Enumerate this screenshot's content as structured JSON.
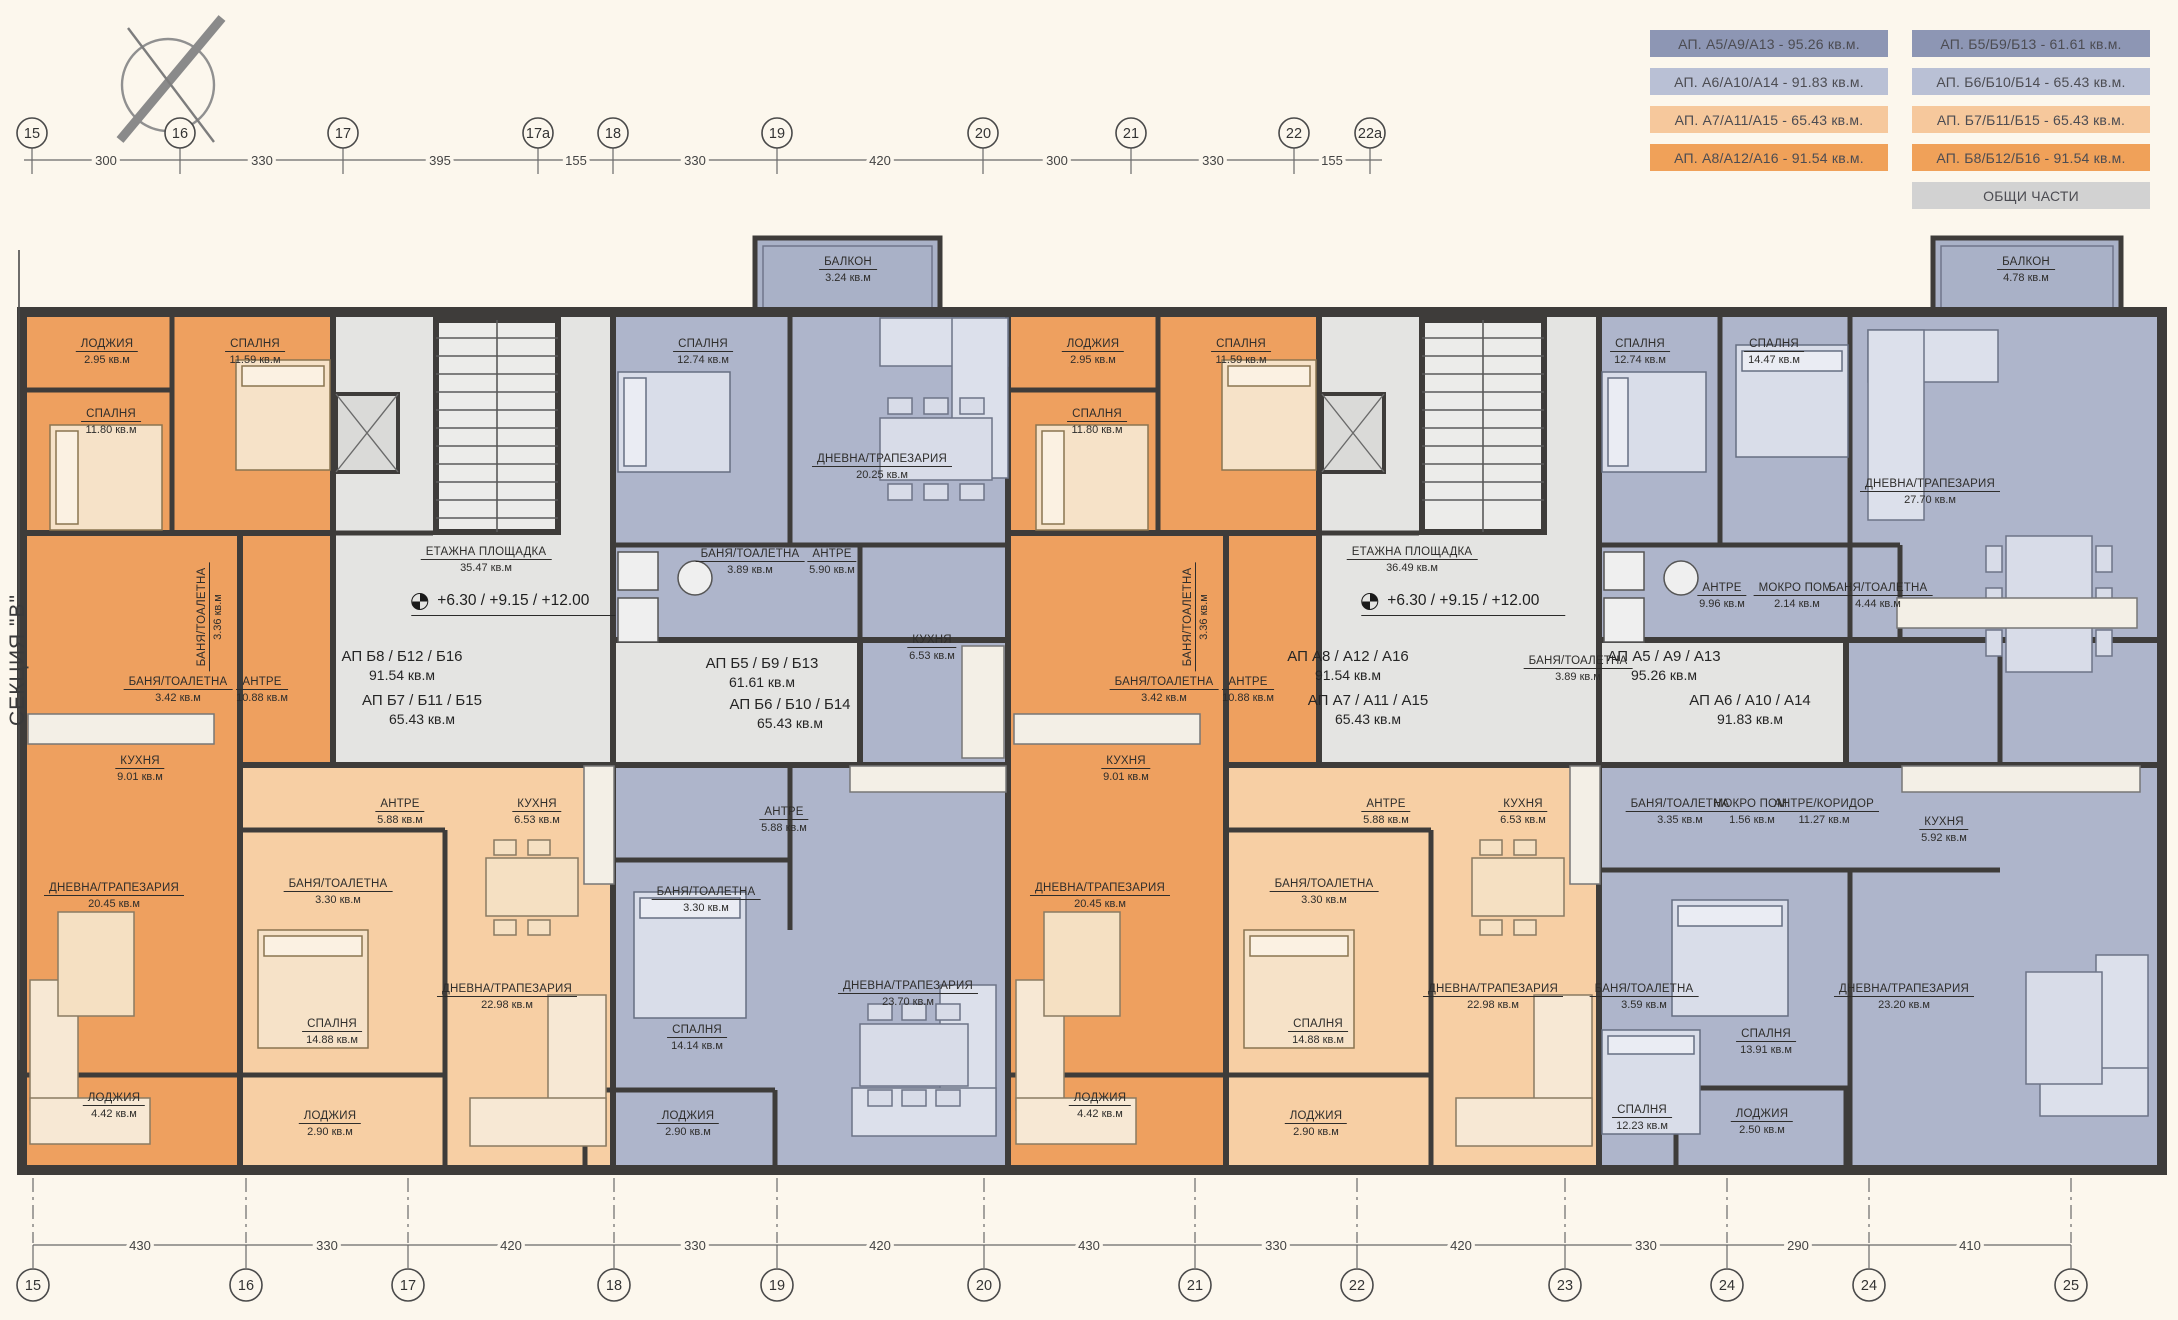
{
  "section_label": "СЕКЦИЯ \"В\"",
  "colors": {
    "dark_orange": "#EEA05F",
    "light_orange": "#F7CFA4",
    "blue": "#AEB5CB",
    "common_gray": "#E4E4E2",
    "wall": "#3E3C3A",
    "background": "#FCF7ED",
    "legend_dark_blue": "#8D96B4",
    "legend_light_blue": "#B9C0D5",
    "legend_light_orange": "#F6C89C",
    "legend_dark_orange": "#F0A159",
    "legend_gray": "#D2D2D2"
  },
  "legend": {
    "common": "ОБЩИ ЧАСТИ",
    "col_a": [
      {
        "label": "АП. А5/А9/А13 - 95.26 кв.м.",
        "color": "#8D96B4"
      },
      {
        "label": "АП. А6/А10/А14 - 91.83 кв.м.",
        "color": "#B9C0D5"
      },
      {
        "label": "АП. А7/А11/А15 - 65.43 кв.м.",
        "color": "#F6C89C"
      },
      {
        "label": "АП. А8/А12/А16 - 91.54 кв.м.",
        "color": "#F0A159"
      }
    ],
    "col_b": [
      {
        "label": "АП. Б5/Б9/Б13 - 61.61 кв.м.",
        "color": "#8D96B4"
      },
      {
        "label": "АП. Б6/Б10/Б14 - 65.43 кв.м.",
        "color": "#B9C0D5"
      },
      {
        "label": "АП. Б7/Б11/Б15 - 65.43 кв.м.",
        "color": "#F6C89C"
      },
      {
        "label": "АП. Б8/Б12/Б16 - 91.54 кв.м.",
        "color": "#F0A159"
      }
    ]
  },
  "axes": {
    "top": {
      "bubbles": [
        {
          "label": "15",
          "x": 32
        },
        {
          "label": "16",
          "x": 180
        },
        {
          "label": "17",
          "x": 343
        },
        {
          "label": "17а",
          "x": 538
        },
        {
          "label": "18",
          "x": 613
        },
        {
          "label": "19",
          "x": 777
        },
        {
          "label": "20",
          "x": 983
        },
        {
          "label": "21",
          "x": 1131
        },
        {
          "label": "22",
          "x": 1294
        },
        {
          "label": "22а",
          "x": 1370
        }
      ],
      "dims": [
        {
          "label": "300",
          "x": 106
        },
        {
          "label": "330",
          "x": 262
        },
        {
          "label": "395",
          "x": 440
        },
        {
          "label": "155",
          "x": 576
        },
        {
          "label": "330",
          "x": 695
        },
        {
          "label": "420",
          "x": 880
        },
        {
          "label": "300",
          "x": 1057
        },
        {
          "label": "330",
          "x": 1213
        },
        {
          "label": "155",
          "x": 1332
        }
      ]
    },
    "bottom": {
      "bubbles": [
        {
          "label": "15",
          "x": 33
        },
        {
          "label": "16",
          "x": 246
        },
        {
          "label": "17",
          "x": 408
        },
        {
          "label": "18",
          "x": 614
        },
        {
          "label": "19",
          "x": 777
        },
        {
          "label": "20",
          "x": 984
        },
        {
          "label": "21",
          "x": 1195
        },
        {
          "label": "22",
          "x": 1357
        },
        {
          "label": "23",
          "x": 1565
        },
        {
          "label": "24",
          "x": 1727
        },
        {
          "label": "24",
          "x": 1869
        },
        {
          "label": "25",
          "x": 2071
        }
      ],
      "dims": [
        {
          "label": "430",
          "x": 140
        },
        {
          "label": "330",
          "x": 327
        },
        {
          "label": "420",
          "x": 511
        },
        {
          "label": "330",
          "x": 695
        },
        {
          "label": "420",
          "x": 880
        },
        {
          "label": "430",
          "x": 1089
        },
        {
          "label": "330",
          "x": 1276
        },
        {
          "label": "420",
          "x": 1461
        },
        {
          "label": "330",
          "x": 1646
        },
        {
          "label": "290",
          "x": 1798
        },
        {
          "label": "410",
          "x": 1970
        }
      ]
    }
  },
  "apartments": [
    {
      "name": "АП Б8 / Б12 / Б16",
      "area": "91.54 кв.м",
      "x": 402,
      "y": 648
    },
    {
      "name": "АП Б7 / Б11 / Б15",
      "area": "65.43 кв.м",
      "x": 422,
      "y": 692
    },
    {
      "name": "АП Б5 / Б9 / Б13",
      "area": "61.61 кв.м",
      "x": 762,
      "y": 655
    },
    {
      "name": "АП Б6 / Б10 / Б14",
      "area": "65.43 кв.м",
      "x": 790,
      "y": 696
    },
    {
      "name": "АП А8 / А12 / А16",
      "area": "91.54 кв.м",
      "x": 1348,
      "y": 648
    },
    {
      "name": "АП А7 / А11 / А15",
      "area": "65.43 кв.м",
      "x": 1368,
      "y": 692
    },
    {
      "name": "АП А5 / А9 / А13",
      "area": "95.26 кв.м",
      "x": 1664,
      "y": 648
    },
    {
      "name": "АП А6 / А10 / А14",
      "area": "91.83 кв.м",
      "x": 1750,
      "y": 692
    }
  ],
  "level_marks": [
    {
      "text": "+6.30 / +9.15 / +12.00",
      "x": 497,
      "y": 592
    },
    {
      "text": "+6.30 / +9.15 / +12.00",
      "x": 1447,
      "y": 592
    }
  ],
  "rooms": [
    {
      "name": "ЛОДЖИЯ",
      "area": "2.95 кв.м",
      "x": 107,
      "y": 338,
      "cls": "room"
    },
    {
      "name": "СПАЛНЯ",
      "area": "11.59 кв.м",
      "x": 255,
      "y": 338,
      "cls": "room"
    },
    {
      "name": "СПАЛНЯ",
      "area": "11.80 кв.м",
      "x": 111,
      "y": 408,
      "cls": "room"
    },
    {
      "name": "БАНЯ/ТОАЛЕТНА",
      "area": "3.36 кв.м",
      "x": 210,
      "y": 617,
      "cls": "room vert"
    },
    {
      "name": "БАНЯ/ТОАЛЕТНА",
      "area": "3.42 кв.м",
      "x": 178,
      "y": 676,
      "cls": "room"
    },
    {
      "name": "АНТРЕ",
      "area": "10.88 кв.м",
      "x": 262,
      "y": 676,
      "cls": "room"
    },
    {
      "name": "КУХНЯ",
      "area": "9.01 кв.м",
      "x": 140,
      "y": 755,
      "cls": "room"
    },
    {
      "name": "ДНЕВНА/ТРАПЕЗАРИЯ",
      "area": "20.45 кв.м",
      "x": 114,
      "y": 882,
      "cls": "room"
    },
    {
      "name": "ЛОДЖИЯ",
      "area": "4.42 кв.м",
      "x": 114,
      "y": 1092,
      "cls": "room"
    },
    {
      "name": "АНТРЕ",
      "area": "5.88 кв.м",
      "x": 400,
      "y": 798,
      "cls": "room"
    },
    {
      "name": "БАНЯ/ТОАЛЕТНА",
      "area": "3.30 кв.м",
      "x": 338,
      "y": 878,
      "cls": "room"
    },
    {
      "name": "СПАЛНЯ",
      "area": "14.88 кв.м",
      "x": 332,
      "y": 1018,
      "cls": "room"
    },
    {
      "name": "ЛОДЖИЯ",
      "area": "2.90 кв.м",
      "x": 330,
      "y": 1110,
      "cls": "room"
    },
    {
      "name": "КУХНЯ",
      "area": "6.53 кв.м",
      "x": 537,
      "y": 798,
      "cls": "room"
    },
    {
      "name": "ДНЕВНА/ТРАПЕЗАРИЯ",
      "area": "22.98 кв.м",
      "x": 507,
      "y": 983,
      "cls": "room"
    },
    {
      "name": "БАЛКОН",
      "area": "3.24 кв.м",
      "x": 848,
      "y": 256,
      "cls": "room"
    },
    {
      "name": "СПАЛНЯ",
      "area": "12.74 кв.м",
      "x": 703,
      "y": 338,
      "cls": "room"
    },
    {
      "name": "ДНЕВНА/ТРАПЕЗАРИЯ",
      "area": "20.25 кв.м",
      "x": 882,
      "y": 453,
      "cls": "room"
    },
    {
      "name": "БАНЯ/ТОАЛЕТНА",
      "area": "3.89 кв.м",
      "x": 750,
      "y": 548,
      "cls": "room"
    },
    {
      "name": "АНТРЕ",
      "area": "5.90 кв.м",
      "x": 832,
      "y": 548,
      "cls": "room"
    },
    {
      "name": "КУХНЯ",
      "area": "6.53 кв.м",
      "x": 932,
      "y": 634,
      "cls": "room"
    },
    {
      "name": "АНТРЕ",
      "area": "5.88 кв.м",
      "x": 784,
      "y": 806,
      "cls": "room"
    },
    {
      "name": "БАНЯ/ТОАЛЕТНА",
      "area": "3.30 кв.м",
      "x": 706,
      "y": 886,
      "cls": "room"
    },
    {
      "name": "СПАЛНЯ",
      "area": "14.14 кв.м",
      "x": 697,
      "y": 1024,
      "cls": "room"
    },
    {
      "name": "ДНЕВНА/ТРАПЕЗАРИЯ",
      "area": "23.70 кв.м",
      "x": 908,
      "y": 980,
      "cls": "room"
    },
    {
      "name": "ЛОДЖИЯ",
      "area": "2.90 кв.м",
      "x": 688,
      "y": 1110,
      "cls": "room"
    },
    {
      "name": "ЕТАЖНА ПЛОЩАДКА",
      "area": "35.47 кв.м",
      "x": 486,
      "y": 546,
      "cls": "room"
    },
    {
      "name": "ЕТАЖНА ПЛОЩАДКА",
      "area": "36.49 кв.м",
      "x": 1412,
      "y": 546,
      "cls": "room"
    },
    {
      "name": "ЛОДЖИЯ",
      "area": "2.95 кв.м",
      "x": 1093,
      "y": 338,
      "cls": "room"
    },
    {
      "name": "СПАЛНЯ",
      "area": "11.59 кв.м",
      "x": 1241,
      "y": 338,
      "cls": "room"
    },
    {
      "name": "СПАЛНЯ",
      "area": "11.80 кв.м",
      "x": 1097,
      "y": 408,
      "cls": "room"
    },
    {
      "name": "БАНЯ/ТОАЛЕТНА",
      "area": "3.36 кв.м",
      "x": 1196,
      "y": 617,
      "cls": "room vert"
    },
    {
      "name": "БАНЯ/ТОАЛЕТНА",
      "area": "3.42 кв.м",
      "x": 1164,
      "y": 676,
      "cls": "room"
    },
    {
      "name": "АНТРЕ",
      "area": "10.88 кв.м",
      "x": 1248,
      "y": 676,
      "cls": "room"
    },
    {
      "name": "КУХНЯ",
      "area": "9.01 кв.м",
      "x": 1126,
      "y": 755,
      "cls": "room"
    },
    {
      "name": "ДНЕВНА/ТРАПЕЗАРИЯ",
      "area": "20.45 кв.м",
      "x": 1100,
      "y": 882,
      "cls": "room"
    },
    {
      "name": "ЛОДЖИЯ",
      "area": "4.42 кв.м",
      "x": 1100,
      "y": 1092,
      "cls": "room"
    },
    {
      "name": "АНТРЕ",
      "area": "5.88 кв.м",
      "x": 1386,
      "y": 798,
      "cls": "room"
    },
    {
      "name": "БАНЯ/ТОАЛЕТНА",
      "area": "3.30 кв.м",
      "x": 1324,
      "y": 878,
      "cls": "room"
    },
    {
      "name": "СПАЛНЯ",
      "area": "14.88 кв.м",
      "x": 1318,
      "y": 1018,
      "cls": "room"
    },
    {
      "name": "ЛОДЖИЯ",
      "area": "2.90 кв.м",
      "x": 1316,
      "y": 1110,
      "cls": "room"
    },
    {
      "name": "КУХНЯ",
      "area": "6.53 кв.м",
      "x": 1523,
      "y": 798,
      "cls": "room"
    },
    {
      "name": "ДНЕВНА/ТРАПЕЗАРИЯ",
      "area": "22.98 кв.м",
      "x": 1493,
      "y": 983,
      "cls": "room"
    },
    {
      "name": "СПАЛНЯ",
      "area": "12.74 кв.м",
      "x": 1640,
      "y": 338,
      "cls": "room"
    },
    {
      "name": "СПАЛНЯ",
      "area": "14.47 кв.м",
      "x": 1774,
      "y": 338,
      "cls": "room"
    },
    {
      "name": "ДНЕВНА/ТРАПЕЗАРИЯ",
      "area": "27.70 кв.м",
      "x": 1930,
      "y": 478,
      "cls": "room"
    },
    {
      "name": "АНТРЕ",
      "area": "9.96 кв.м",
      "x": 1722,
      "y": 582,
      "cls": "room"
    },
    {
      "name": "МОКРО ПОМ.",
      "area": "2.14 кв.м",
      "x": 1797,
      "y": 582,
      "cls": "room"
    },
    {
      "name": "БАНЯ/ТОАЛЕТНА",
      "area": "4.44 кв.м",
      "x": 1878,
      "y": 582,
      "cls": "room"
    },
    {
      "name": "БАНЯ/ТОАЛЕТНА",
      "area": "3.89 кв.м",
      "x": 1578,
      "y": 655,
      "cls": "room"
    },
    {
      "name": "БАЛКОН",
      "area": "4.78 кв.м",
      "x": 2026,
      "y": 256,
      "cls": "room"
    },
    {
      "name": "БАНЯ/ТОАЛЕТНА",
      "area": "3.35 кв.м",
      "x": 1680,
      "y": 798,
      "cls": "room"
    },
    {
      "name": "МОКРО ПОМ.",
      "area": "1.56 кв.м",
      "x": 1752,
      "y": 798,
      "cls": "room"
    },
    {
      "name": "АНТРЕ/КОРИДОР",
      "area": "11.27 кв.м",
      "x": 1824,
      "y": 798,
      "cls": "room"
    },
    {
      "name": "КУХНЯ",
      "area": "5.92 кв.м",
      "x": 1944,
      "y": 816,
      "cls": "room"
    },
    {
      "name": "БАНЯ/ТОАЛЕТНА",
      "area": "3.59 кв.м",
      "x": 1644,
      "y": 983,
      "cls": "room"
    },
    {
      "name": "СПАЛНЯ",
      "area": "13.91 кв.м",
      "x": 1766,
      "y": 1028,
      "cls": "room"
    },
    {
      "name": "ДНЕВНА/ТРАПЕЗАРИЯ",
      "area": "23.20 кв.м",
      "x": 1904,
      "y": 983,
      "cls": "room"
    },
    {
      "name": "СПАЛНЯ",
      "area": "12.23 кв.м",
      "x": 1642,
      "y": 1104,
      "cls": "room"
    },
    {
      "name": "ЛОДЖИЯ",
      "area": "2.50 кв.м",
      "x": 1762,
      "y": 1108,
      "cls": "room"
    }
  ]
}
